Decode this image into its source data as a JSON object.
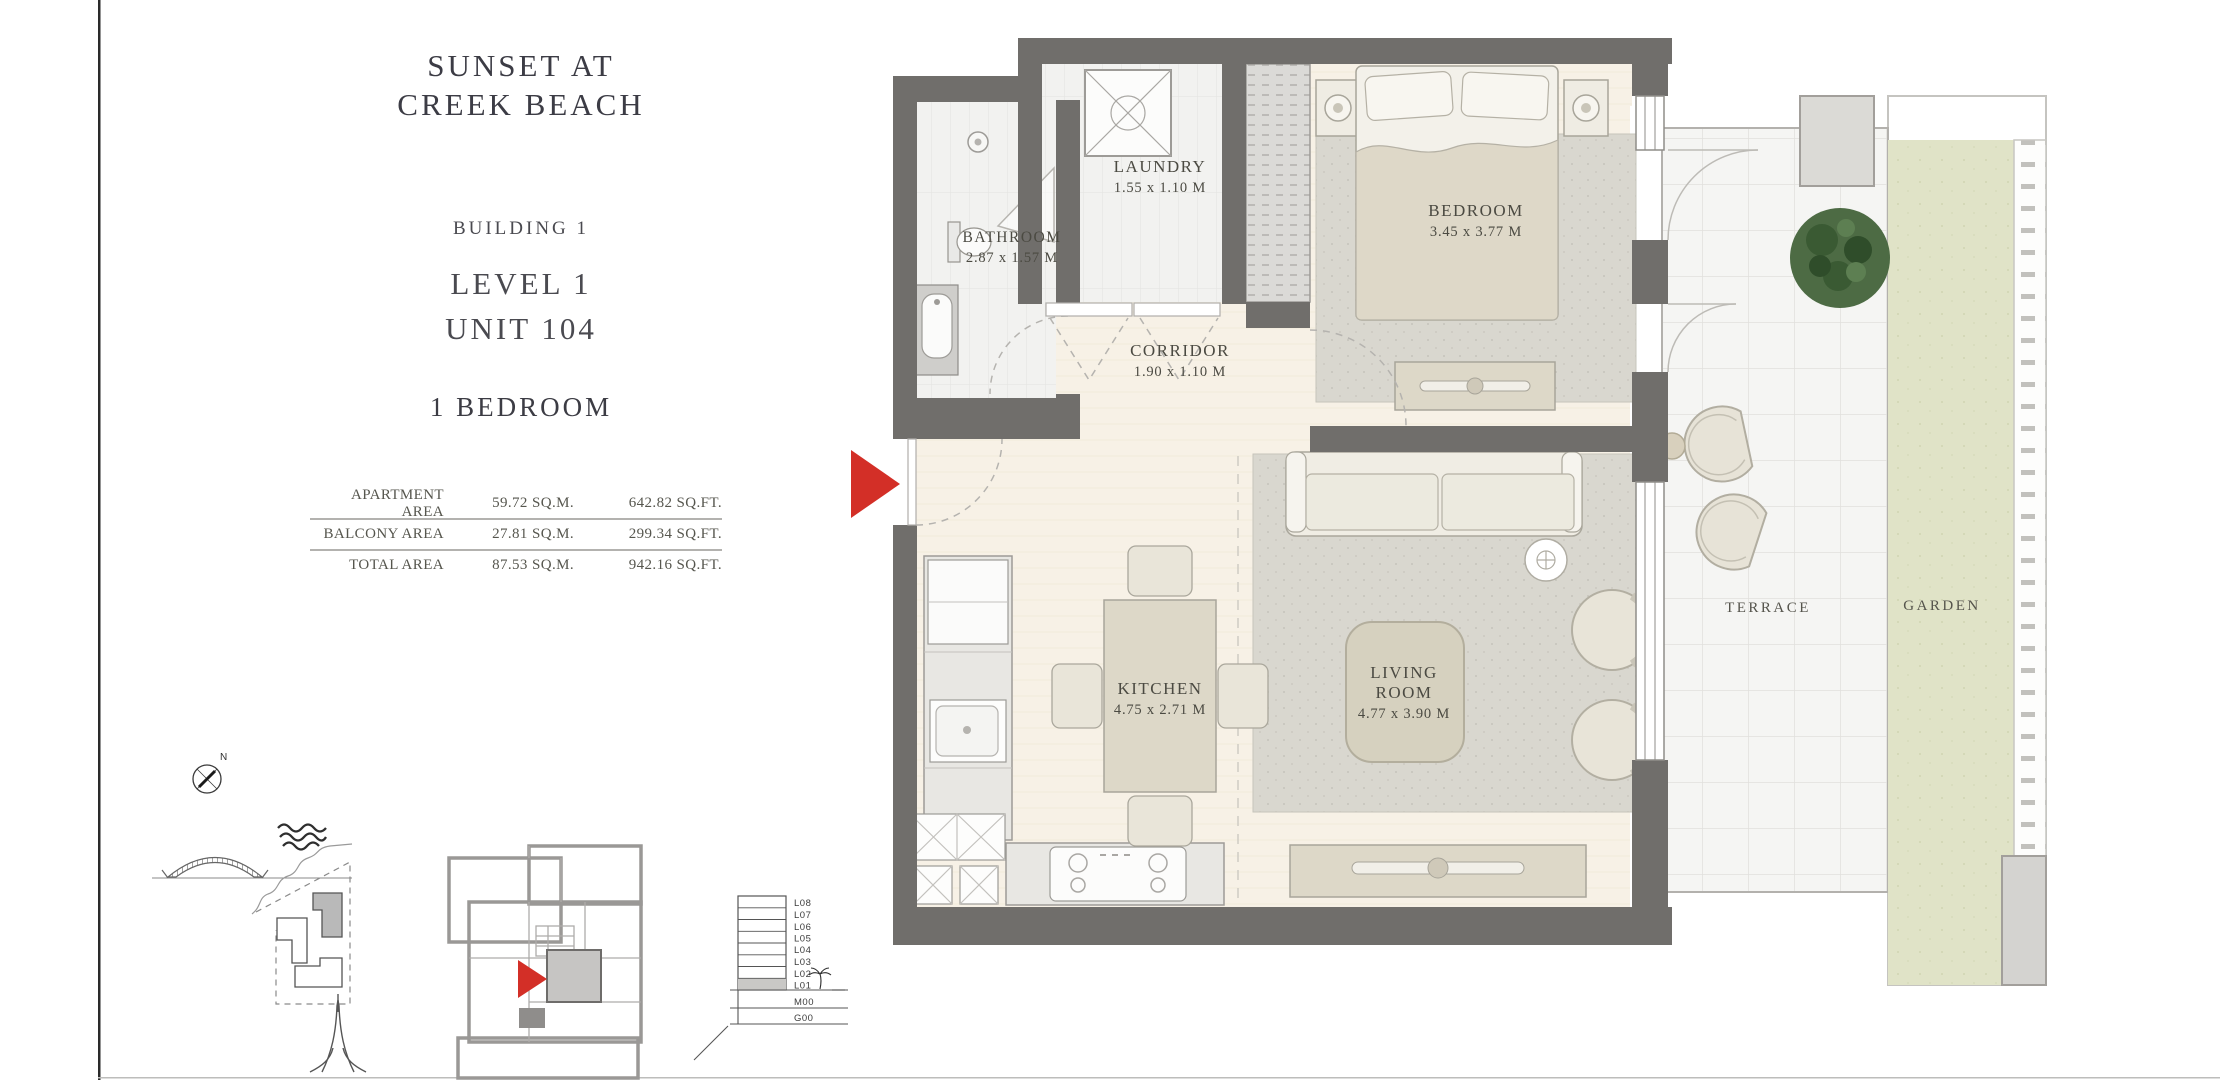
{
  "document": {
    "project_line1": "SUNSET AT",
    "project_line2": "CREEK BEACH",
    "building": "BUILDING 1",
    "level": "LEVEL 1",
    "unit": "UNIT 104",
    "unit_type": "1 BEDROOM"
  },
  "area_table": {
    "rows": [
      {
        "label": "APARTMENT AREA",
        "sqm": "59.72 SQ.M.",
        "sqft": "642.82 SQ.FT."
      },
      {
        "label": "BALCONY AREA",
        "sqm": "27.81 SQ.M.",
        "sqft": "299.34 SQ.FT."
      },
      {
        "label": "TOTAL AREA",
        "sqm": "87.53 SQ.M.",
        "sqft": "942.16 SQ.FT."
      }
    ]
  },
  "floor_plan": {
    "rooms": {
      "laundry": {
        "name": "LAUNDRY",
        "dims": "1.55 x 1.10 M"
      },
      "bathroom": {
        "name": "BATHROOM",
        "dims": "2.87 x 1.57 M"
      },
      "corridor": {
        "name": "CORRIDOR",
        "dims": "1.90 x 1.10 M"
      },
      "bedroom": {
        "name": "BEDROOM",
        "dims": "3.45 x 3.77 M"
      },
      "kitchen": {
        "name": "KITCHEN",
        "dims": "4.75 x 2.71 M"
      },
      "living_room": {
        "name_line1": "LIVING",
        "name_line2": "ROOM",
        "dims": "4.77 x 3.90 M"
      },
      "terrace": {
        "name": "TERRACE"
      },
      "garden": {
        "name": "GARDEN"
      }
    }
  },
  "level_diagram": {
    "levels": [
      "L08",
      "L07",
      "L06",
      "L05",
      "L04",
      "L03",
      "L02",
      "L01",
      "M00",
      "G00"
    ],
    "highlighted_level": "L01"
  },
  "compass": {
    "north": "N"
  },
  "colors": {
    "wall": "#706e6b",
    "floor": "#f7f1e6",
    "tile": "#f2f2f0",
    "terrace": "#f5f5f3",
    "garden": "#e0e3c7",
    "rug": "#d9d7cf",
    "accent_red": "#d32f27",
    "text": "#4b4a42"
  }
}
